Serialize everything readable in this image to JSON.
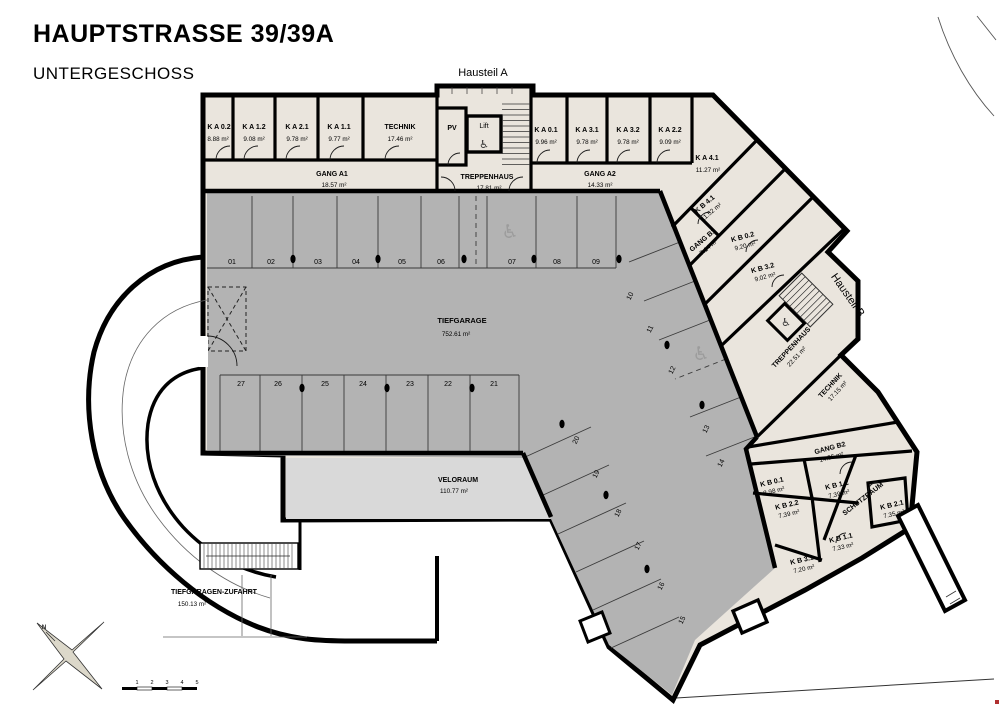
{
  "header": {
    "title": "HAUPTSTRASSE 39/39A",
    "subtitle": "UNTERGESCHOSS"
  },
  "site": {
    "hausteil_a": "Hausteil A",
    "hausteil_b": "Hausteil B",
    "north": "N"
  },
  "icons": {
    "wheelchair": "♿"
  },
  "rooms_a": [
    {
      "name": "K A 0.2",
      "area": "8.88 m²"
    },
    {
      "name": "K A 1.2",
      "area": "9.08 m²"
    },
    {
      "name": "K A 2.1",
      "area": "9.78 m²"
    },
    {
      "name": "K A 1.1",
      "area": "9.77 m²"
    },
    {
      "name": "TECHNIK",
      "area": "17.46 m²"
    },
    {
      "name": "PV",
      "area": ""
    },
    {
      "name": "Lift",
      "area": ""
    },
    {
      "name": "TREPPENHAUS",
      "area": "17.81 m²"
    },
    {
      "name": "GANG A1",
      "area": "18.57 m²"
    },
    {
      "name": "K A 0.1",
      "area": "9.96 m²"
    },
    {
      "name": "K A 3.1",
      "area": "9.78 m²"
    },
    {
      "name": "K A 3.2",
      "area": "9.78 m²"
    },
    {
      "name": "K A 2.2",
      "area": "9.09 m²"
    },
    {
      "name": "GANG A2",
      "area": "14.33 m²"
    },
    {
      "name": "K A 4.1",
      "area": "11.27 m²"
    }
  ],
  "rooms_b": [
    {
      "name": "K B 4.1",
      "area": "11.52 m²"
    },
    {
      "name": "GANG B1",
      "area": "7.14 m²"
    },
    {
      "name": "K B 0.2",
      "area": "9.20 m²"
    },
    {
      "name": "K B 3.2",
      "area": "9.02 m²"
    },
    {
      "name": "TREPPENHAUS",
      "area": "22.51 m²"
    },
    {
      "name": "TECHNIK",
      "area": "17.15 m²"
    },
    {
      "name": "GANG B2",
      "area": "14.55 m²"
    },
    {
      "name": "K B 0.1",
      "area": "8.98 m²"
    },
    {
      "name": "K B 1.2",
      "area": "7.39 m²"
    },
    {
      "name": "K B 2.2",
      "area": "7.39 m²"
    },
    {
      "name": "SCHUTZRAUM",
      "area": ""
    },
    {
      "name": "K B 2.1",
      "area": "7.35 m²"
    },
    {
      "name": "K B 1.1",
      "area": "7.33 m²"
    },
    {
      "name": "K B 3.1",
      "area": "7.20 m²"
    }
  ],
  "garage": {
    "tiefgarage": {
      "name": "TIEFGARAGE",
      "area": "752.61 m²"
    },
    "veloraum": {
      "name": "VELORAUM",
      "area": "110.77 m²"
    },
    "zufahrt": {
      "name": "TIEFGARAGEN-ZUFAHRT",
      "area": "150.13 m²"
    }
  },
  "parking": {
    "top_row": [
      "01",
      "02",
      "03",
      "04",
      "05",
      "06",
      "07",
      "08",
      "09"
    ],
    "middle_row": [
      "27",
      "26",
      "25",
      "24",
      "23",
      "22",
      "21"
    ],
    "diagonal_upper": [
      "10",
      "11",
      "12",
      "13",
      "14"
    ],
    "diagonal_lower": [
      "20",
      "19",
      "18",
      "17",
      "16",
      "15"
    ]
  },
  "scale_bar": {
    "ticks": [
      "1",
      "2",
      "3",
      "4",
      "5"
    ]
  },
  "colors": {
    "room_fill": "#eae5dd",
    "garage_fill": "#b3b3b3",
    "veloraum_fill": "#d9d9d9",
    "wall": "#000000"
  }
}
